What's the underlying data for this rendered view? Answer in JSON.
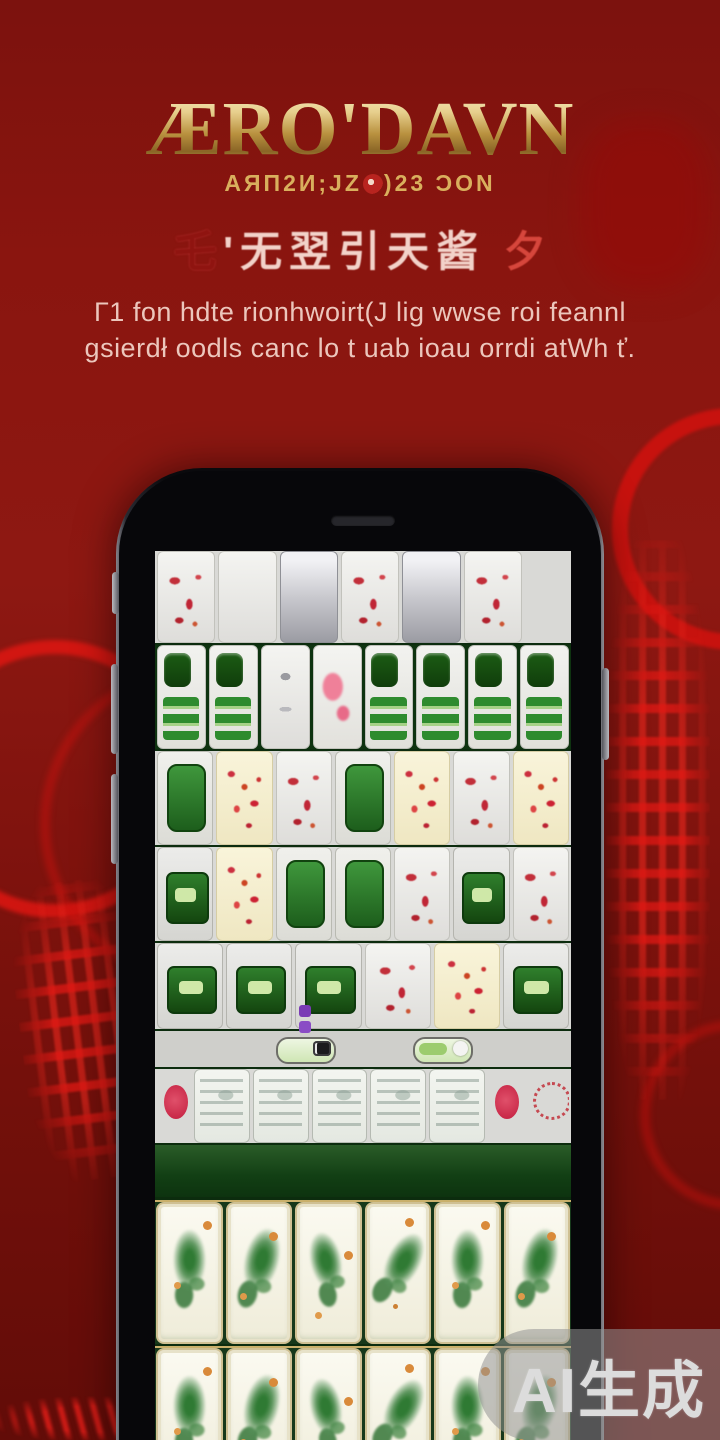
{
  "title": {
    "text": "ÆRO'DAVN",
    "subtitle_left": "AЯΠ2И;JZ",
    "subtitle_right": ")23 ƆON"
  },
  "calligraphy": {
    "lead": "乇",
    "text": "'无翌引天酱",
    "flourish": "夕"
  },
  "tagline": {
    "line1": "Γ1 fon hdte rionhwoirt(J lig wwse roi feannl",
    "line2": "gsierdł oodls canc lo t uab ioau orrdi atWh ť."
  },
  "watermark": {
    "label": "AI生成"
  },
  "colors": {
    "background_red": "#8a150f",
    "ornament_red": "#d21412",
    "title_gold": "#e7cf8d",
    "felt_green": "#123f14",
    "tile_green": "#2e8b2e",
    "tile_red": "#c22f3a",
    "rack_ivory": "#fbfaf1"
  },
  "board": {
    "sections": [
      {
        "kind": "tiles",
        "h": 92,
        "bg": "row-grey",
        "tiles": [
          "wr",
          "wq",
          "gm",
          "wr",
          "gm",
          "wr",
          "dg"
        ]
      },
      {
        "kind": "tiles",
        "h": 104,
        "bg": "row-green",
        "tiles": [
          "gb",
          "gb",
          "ws",
          "pk",
          "gb",
          "gb",
          "gb",
          "gb"
        ]
      },
      {
        "kind": "tiles",
        "h": 94,
        "bg": "row-grey",
        "tiles": [
          "gk",
          "cr",
          "wr",
          "gk",
          "cr",
          "wr",
          "cr"
        ]
      },
      {
        "kind": "tiles",
        "h": 94,
        "bg": "row-grey",
        "tiles": [
          "gc",
          "cr",
          "gk",
          "gk",
          "wr",
          "gc",
          "wr"
        ]
      },
      {
        "kind": "tiles",
        "h": 86,
        "bg": "row-grey",
        "tiles": [
          "gc",
          "gc",
          "gc",
          "wr",
          "cr",
          "gc"
        ]
      },
      {
        "kind": "toggles"
      },
      {
        "kind": "tiles",
        "h": 74,
        "bg": "row-grey",
        "tiles": [
          "hr",
          "ps",
          "ps",
          "ps",
          "ps",
          "ps",
          "hr",
          "rc"
        ]
      },
      {
        "kind": "felt"
      },
      {
        "kind": "rack",
        "tiles": [
          "rk",
          "rk",
          "rk",
          "rk",
          "rk",
          "rk"
        ]
      },
      {
        "kind": "rack",
        "tiles": [
          "rk",
          "rk",
          "rk",
          "rk",
          "rk",
          "rk"
        ]
      }
    ]
  }
}
